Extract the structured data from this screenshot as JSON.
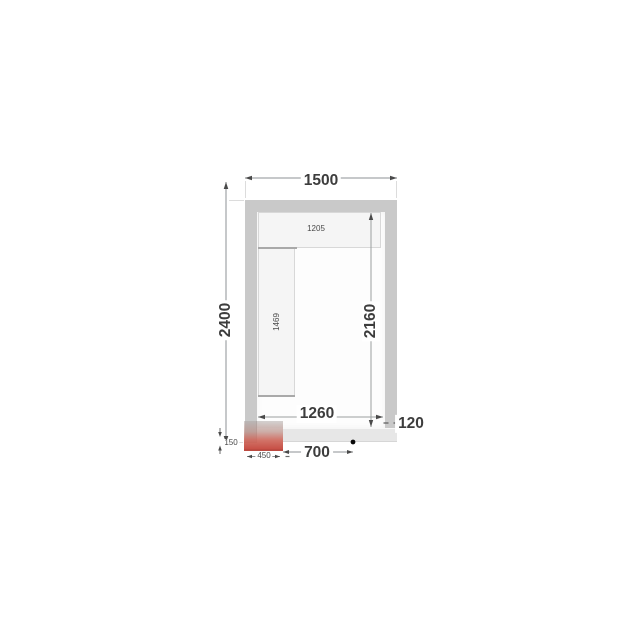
{
  "plan": {
    "description": "cold room floor plan drawing",
    "labels": {
      "outer_width": "1500",
      "outer_depth": "2400",
      "inner_depth": "2160",
      "inner_width": "1260",
      "wall_thickness": "120",
      "door_opening_width": "700",
      "door_panel_width": "450",
      "door_sill_depth": "150",
      "top_shelf_length": "1205",
      "side_shelf_length": "1469"
    },
    "colors": {
      "wall_gray": "#c9c9c9",
      "door_side_wall_gray": "#e7e7e7",
      "shelf_fill": "#f5f5f5",
      "door_red": "#c6584c",
      "dimension_text": "#3d3d3d",
      "dimension_line": "#8e9294",
      "marker_dot": "#0a0a0a"
    }
  }
}
